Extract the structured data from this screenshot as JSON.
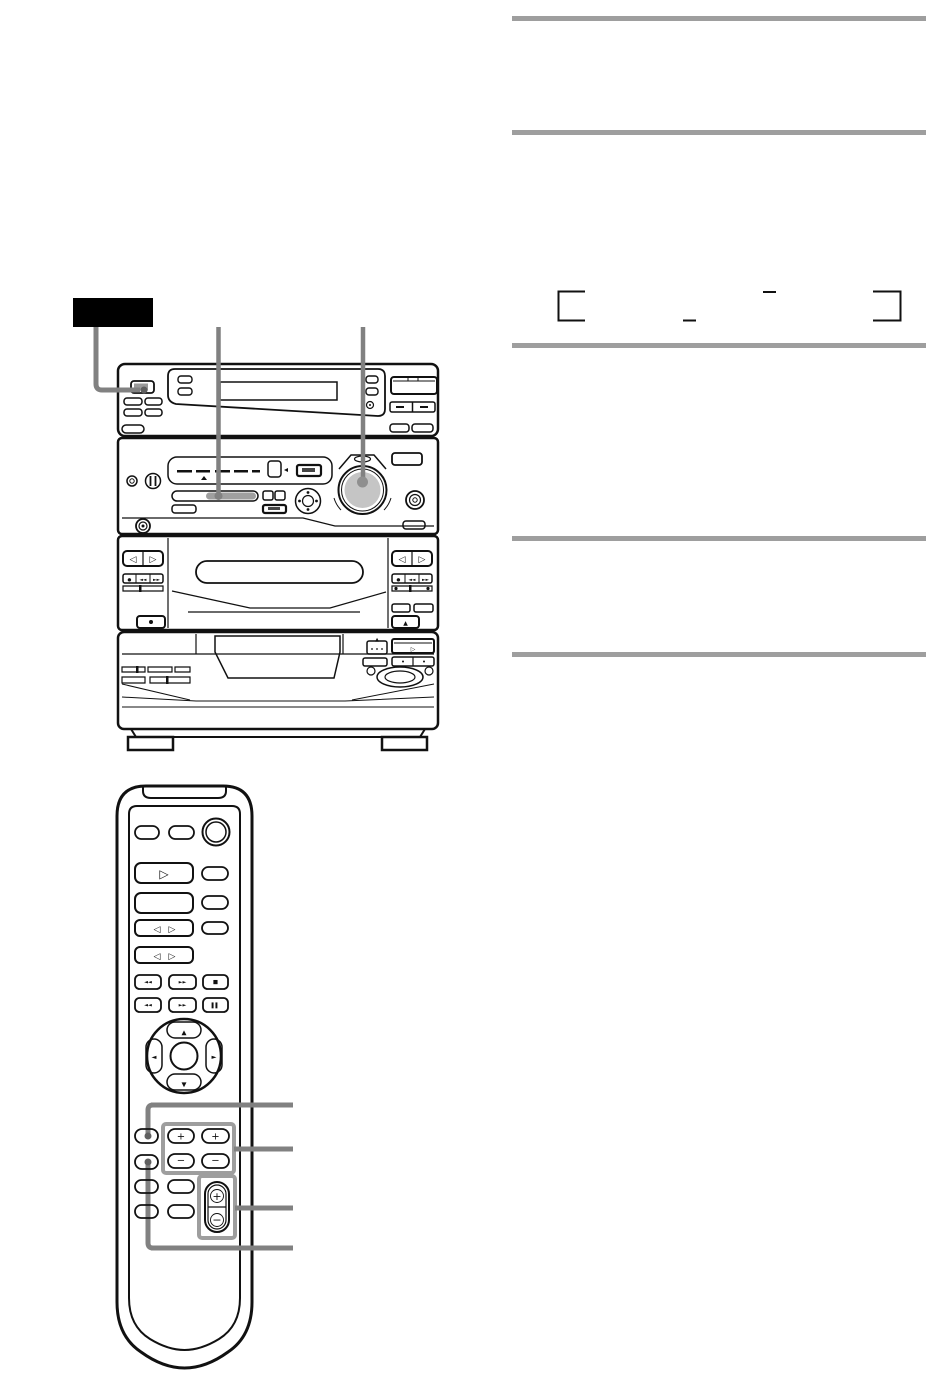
{
  "page": {
    "kind": "audio system instruction manual page (graphics only, body text not visible)",
    "background": "#ffffff"
  },
  "colors": {
    "line_art": "#111111",
    "section_rule_gray": "#9e9e9e",
    "callout_gray": "#818181",
    "highlight_box_gray": "#9e9e9e",
    "step_label_bg": "#000000",
    "knob_fill": "#c5c5c5",
    "gray_button_fill": "#b5b5b5",
    "plus_minus_button_fill": "#cdcdcd",
    "function_strip_fill": "#9f9f9f"
  },
  "right_column": {
    "rule_count": 5,
    "display_frame_figure": "empty display frame shown by corner brackets and tick marks"
  },
  "main_unit": {
    "figure": "front view of mini hi-fi component system (display deck, tuner/amplifier with large knob, dual cassette deck, CD changer)",
    "callouts": {
      "step_label_to_power_button": true,
      "line_to_function_strip": true,
      "line_to_large_knob": true
    },
    "glyphs": {
      "direction_left": "◁",
      "direction_right": "▷",
      "rewind": "◄◄",
      "ffwd": "►►",
      "record_dot": "●",
      "eject": "▲",
      "play": "▷",
      "disc_skip": "▲"
    }
  },
  "remote": {
    "figure": "remote commander with power, play, direction, transport, navigation pad, preset +/- and volume +/- keys",
    "callout_count": 4,
    "glyphs": {
      "play": "▷",
      "direction_left": "◁",
      "direction_right": "▷",
      "prev": "◄◄",
      "next": "►►",
      "stop": "■",
      "rewind": "◄◄",
      "ffwd": "►►",
      "pause": "▌▌",
      "nav_up": "▲",
      "nav_down": "▼",
      "nav_left": "◄",
      "nav_right": "►",
      "tuning_plus": "+",
      "tuning_minus": "−",
      "vol_plus": "+",
      "vol_minus": "−"
    }
  }
}
